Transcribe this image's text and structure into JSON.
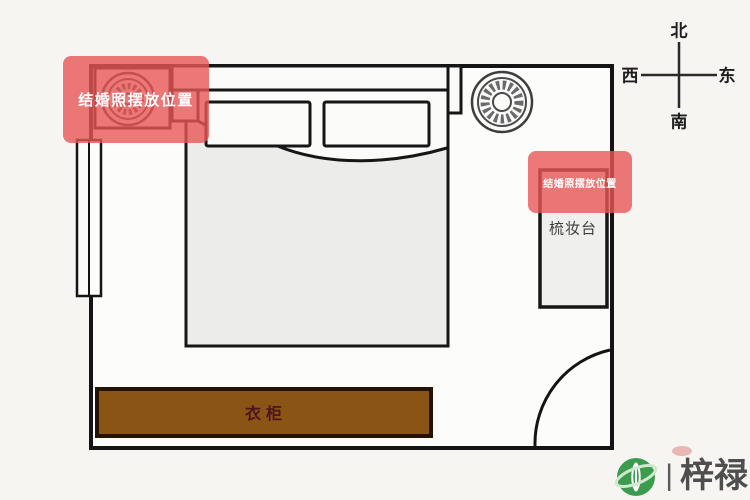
{
  "diagram": {
    "type": "bedroom-floorplan",
    "purpose": "wedding photo placement feng shui diagram"
  },
  "compass": {
    "north": "北",
    "south": "南",
    "west": "西",
    "east": "东"
  },
  "furniture": {
    "wardrobe_label": "衣柜",
    "dressing_table_label": "梳妆台"
  },
  "highlights": {
    "bedside_spot_label": "结婚照摆放位置",
    "dresser_spot_label": "结婚照摆放位置",
    "highlight_color": "#e75656"
  },
  "colors": {
    "wall": "#141414",
    "wardrobe_fill": "#8a5414",
    "bed_fill": "#ececea",
    "background": "#f6f5f2"
  },
  "watermark": {
    "separator": "|",
    "brand": "梓禄"
  }
}
